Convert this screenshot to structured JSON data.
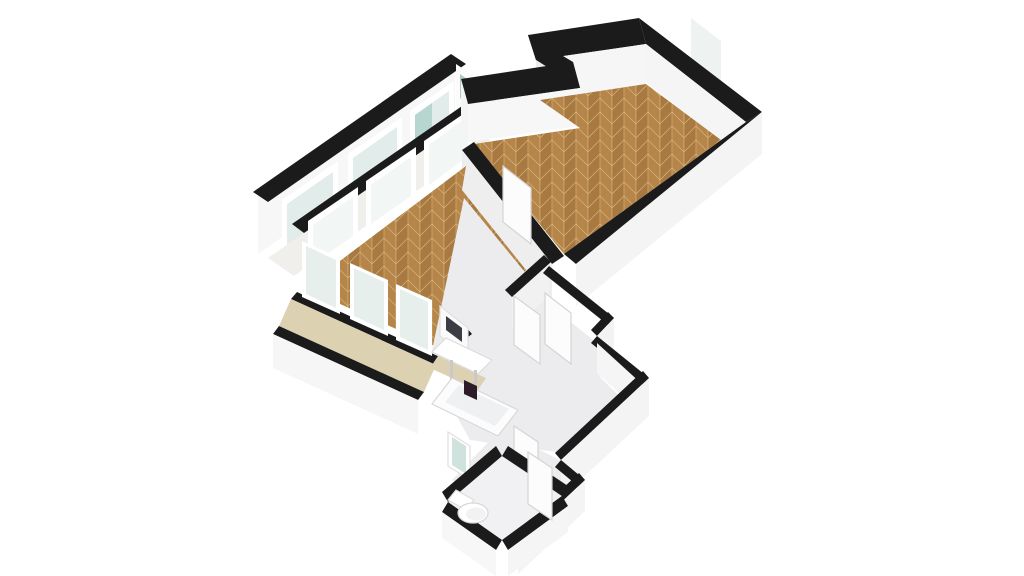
{
  "palette": {
    "background": "#ffffff",
    "wall_top": "#1b1b1b",
    "wall_face": "#f2f2f2",
    "parquet_a": "#b5854a",
    "parquet_b": "#a87a41",
    "parquet_line": "#d8b57c",
    "balcony_floor": "#f0efeb",
    "beige_floor": "#dcd2b2",
    "hall_floor": "#ececef",
    "glass": "#e2ecea",
    "glass_teal": "#aed0c9",
    "dark_accent": "#2e1b29"
  },
  "rooms": [
    {
      "name": "bedroom",
      "floor": "parquet-herringbone"
    },
    {
      "name": "living-room",
      "floor": "parquet-herringbone"
    },
    {
      "name": "balcony-north",
      "floor": "light"
    },
    {
      "name": "balcony-south",
      "floor": "beige"
    },
    {
      "name": "bathroom",
      "floor": "light-gray"
    },
    {
      "name": "hallway",
      "floor": "light-gray"
    },
    {
      "name": "wc",
      "floor": "light-gray"
    }
  ],
  "fixtures": [
    "toilet",
    "bathtub",
    "washbasin",
    "mirror-panel",
    "interior-doors",
    "windows",
    "glass-doors"
  ],
  "scene": {
    "shapes": [
      {
        "n": "balcony-outer-wall-face",
        "t": "p",
        "f": "#f7f7f7",
        "p": "258,196 455,58 455,116 258,254"
      },
      {
        "n": "balcony-outer-wall-top",
        "t": "p",
        "f": "#1b1b1b",
        "p": "253,192 451,54 466,64 268,202"
      },
      {
        "n": "balcony-window-1-frame",
        "t": "p",
        "f": "#ffffff",
        "p": "282,200 338,161 338,219 282,258"
      },
      {
        "n": "balcony-window-1-glass",
        "t": "p",
        "f": "#e2ecea",
        "p": "287,204 333,172 333,213 287,245"
      },
      {
        "n": "balcony-window-2-frame",
        "t": "p",
        "f": "#ffffff",
        "p": "348,154 402,117 402,175 348,212"
      },
      {
        "n": "balcony-window-2-glass",
        "t": "p",
        "f": "#e2ecea",
        "p": "353,158 397,127 397,169 353,200"
      },
      {
        "n": "balcony-window-3-frame",
        "t": "p",
        "f": "#ffffff",
        "p": "410,111 454,81 454,139 410,177"
      },
      {
        "n": "balcony-window-3-glass",
        "t": "p",
        "f": "#e2ecea",
        "p": "415,115 449,91 449,133 415,165"
      },
      {
        "n": "balcony-window-3-teal-pane",
        "t": "p",
        "f": "#b7d6cf",
        "p": "415,115 432,103 432,146 415,158"
      },
      {
        "n": "balcony-floor",
        "t": "p",
        "f": "#f0efeb",
        "p": "268,258 464,122 490,140 294,276"
      },
      {
        "n": "balcony-end-wall",
        "t": "p",
        "f": "#fbfbfb",
        "p": "456,64 480,80 480,132 456,116"
      },
      {
        "n": "balcony-end-glass",
        "t": "p",
        "f": "#a9cdc6",
        "p": "460,74 474,84 474,108 460,98"
      },
      {
        "n": "balcony-inner-wall-top",
        "t": "p",
        "f": "#1b1b1b",
        "p": "292,224 488,88 500,97 304,233"
      },
      {
        "n": "glass-door-1-frame",
        "t": "p",
        "f": "#ffffff",
        "p": "308,221 358,187 358,242 308,276"
      },
      {
        "n": "glass-door-1-glass",
        "t": "p",
        "f": "#eef3f1",
        "o": 0.75,
        "p": "313,225 353,197 353,236 313,264"
      },
      {
        "n": "glass-door-2-frame",
        "t": "p",
        "f": "#ffffff",
        "p": "366,181 416,147 416,202 366,236"
      },
      {
        "n": "glass-door-2-glass",
        "t": "p",
        "f": "#eef3f1",
        "o": 0.75,
        "p": "371,185 411,157 411,196 371,224"
      },
      {
        "n": "glass-door-3-frame",
        "t": "p",
        "f": "#ffffff",
        "p": "424,141 472,108 472,163 424,196"
      },
      {
        "n": "glass-door-3-glass",
        "t": "p",
        "f": "#eef3f1",
        "o": 0.75,
        "p": "429,145 467,117 467,157 429,185"
      },
      {
        "n": "bedroom-window-frame",
        "t": "p",
        "f": "#ffffff",
        "p": "686,12 726,43 726,97 686,66"
      },
      {
        "n": "bedroom-window-glass",
        "t": "p",
        "f": "#eef2f1",
        "p": "691,18 721,41 721,91 691,68"
      },
      {
        "n": "bedroom-window-sill",
        "t": "p",
        "f": "#f1f1f1",
        "p": "680,58 732,98 732,108 680,68"
      },
      {
        "n": "bedroom-ne-wall-top",
        "t": "p",
        "f": "#1b1b1b",
        "p": "639,18 762,112 746,122 646,44"
      },
      {
        "n": "bedroom-ne-wall-face",
        "t": "p",
        "f": "#f5f5f5",
        "p": "646,44 746,122 746,160 646,82"
      },
      {
        "n": "bedroom-facade-top",
        "t": "p",
        "f": "#1b1b1b",
        "p": "639,18 646,44 536,60 528,35"
      },
      {
        "n": "bedroom-facade-face",
        "t": "p",
        "f": "#f6f6f6",
        "p": "646,44 536,60 536,100 646,84"
      },
      {
        "n": "notch-step-top",
        "t": "p",
        "f": "#1b1b1b",
        "p": "528,35 536,60 580,88 573,62"
      },
      {
        "n": "notch-step-face",
        "t": "p",
        "f": "#ededed",
        "p": "536,60 580,88 580,126 536,98"
      },
      {
        "n": "notch-run-top",
        "t": "p",
        "f": "#1b1b1b",
        "p": "573,62 580,88 468,104 461,79"
      },
      {
        "n": "notch-run-face",
        "t": "p",
        "f": "#f7f7f7",
        "p": "580,88 468,104 468,142 580,126"
      },
      {
        "n": "bedroom-west-face",
        "t": "p",
        "f": "#f4f4f4",
        "p": "461,79 468,104 468,150 461,125"
      },
      {
        "n": "bedroom-floor",
        "t": "p",
        "f": "parquet",
        "p": "646,84 721,140 564,254 474,144 580,128 540,100"
      },
      {
        "n": "bedroom-se-wall-top",
        "t": "p",
        "f": "#1b1b1b",
        "p": "762,112 576,264 564,254 746,122"
      },
      {
        "n": "bedroom-se-outer-face",
        "t": "p",
        "f": "#f4f4f4",
        "p": "762,112 576,264 576,306 762,154"
      },
      {
        "n": "bedroom-spine-wall-top",
        "t": "p",
        "f": "#1b1b1b",
        "p": "474,142 564,256 552,264 462,150"
      },
      {
        "n": "bedroom-spine-wall-face",
        "t": "p",
        "f": "#eeeeee",
        "p": "462,150 552,264 552,306 462,192"
      },
      {
        "n": "bedroom-door-1",
        "t": "p",
        "f": "#fcfcfc",
        "s": "#d5d5d5",
        "p": "503,166 531,188 531,244 503,222"
      },
      {
        "n": "bedroom-door-2",
        "t": "p",
        "f": "#fcfcfc",
        "s": "#d5d5d5",
        "p": "500,253 528,274 528,328 500,307"
      },
      {
        "n": "living-room-floor",
        "t": "p",
        "f": "parquet",
        "p": "304,288 466,166 462,190 526,270 448,352"
      },
      {
        "n": "hall-floor-upper",
        "t": "p",
        "f": "#ececef",
        "p": "464,198 556,310 486,384 430,360"
      },
      {
        "n": "hall-floor-right",
        "t": "p",
        "f": "#ececef",
        "p": "556,310 618,360 600,377 618,395 556,452 470,440 442,390 486,350"
      },
      {
        "n": "hall-floor-lower",
        "t": "p",
        "f": "#ececef",
        "p": "500,430 580,470 520,530 452,480"
      },
      {
        "n": "living-se-wall-face",
        "t": "p",
        "f": "#f1f1f1",
        "p": "549,260 512,294 512,330 549,296"
      },
      {
        "n": "living-se-wall-top-1",
        "t": "p",
        "f": "#1b1b1b",
        "p": "551,262 512,297 505,290 544,255"
      },
      {
        "n": "living-se-wall-top-2",
        "t": "p",
        "f": "#1b1b1b",
        "p": "472,334 448,352 441,344 465,326"
      },
      {
        "n": "living-se-door",
        "t": "p",
        "f": "#fcfcfc",
        "s": "#d5d5d5",
        "p": "514,296 540,315 540,364 514,345"
      },
      {
        "n": "sill-wall-top",
        "t": "p",
        "f": "#1b1b1b",
        "p": "297,292 442,358 436,365 291,299"
      },
      {
        "n": "beige-balcony-floor",
        "t": "p",
        "f": "#dcd2b2",
        "p": "291,299 436,365 424,392 279,326"
      },
      {
        "n": "beige-window-1-frame",
        "t": "p",
        "f": "#ffffff",
        "p": "302,241 340,258 340,314 302,297"
      },
      {
        "n": "beige-window-1-glass",
        "t": "p",
        "f": "#e3ece9",
        "o": 0.85,
        "p": "306,246 336,260 336,308 306,294"
      },
      {
        "n": "beige-window-2-frame",
        "t": "p",
        "f": "#ffffff",
        "p": "350,263 388,280 388,336 350,319"
      },
      {
        "n": "beige-window-2-glass",
        "t": "p",
        "f": "#e3ece9",
        "o": 0.85,
        "p": "354,268 384,282 384,330 354,316"
      },
      {
        "n": "beige-window-3-frame",
        "t": "p",
        "f": "#ffffff",
        "p": "396,284 432,300 432,356 396,340"
      },
      {
        "n": "beige-window-3-glass",
        "t": "p",
        "f": "#e3ece9",
        "o": 0.85,
        "p": "400,289 428,302 428,350 400,337"
      },
      {
        "n": "beige-outer-wall-top",
        "t": "p",
        "f": "#1b1b1b",
        "p": "279,326 424,392 418,400 273,334"
      },
      {
        "n": "beige-outer-wall-face",
        "t": "p",
        "f": "#f6f6f6",
        "p": "273,334 418,400 418,434 273,368"
      },
      {
        "n": "beige-ledge",
        "t": "p",
        "f": "#dcd2b2",
        "p": "438,356 486,378 478,390 430,368"
      },
      {
        "n": "bath-mirror-panel",
        "t": "p",
        "f": "#fafafa",
        "s": "#e0e0e0",
        "p": "440,306 468,328 468,358 440,336"
      },
      {
        "n": "bath-mirror-glass",
        "t": "p",
        "f": "#3c3c44",
        "p": "446,316 462,328 462,342 446,330"
      },
      {
        "n": "bath-sink-table",
        "t": "p",
        "f": "#ffffff",
        "s": "#dcdcdc",
        "p": "446,338 492,360 478,374 432,352"
      },
      {
        "n": "bath-sink-leg-1",
        "t": "p",
        "f": "#c9c9c9",
        "p": "450,360 453,360 453,380 450,380"
      },
      {
        "n": "bath-sink-leg-2",
        "t": "p",
        "f": "#c9c9c9",
        "p": "474,370 477,370 477,390 474,390"
      },
      {
        "n": "bathtub-outer",
        "t": "p",
        "f": "#fcfcfc",
        "s": "#d8d8d8",
        "p": "452,378 518,410 498,436 432,404"
      },
      {
        "n": "bathtub-inner",
        "t": "p",
        "f": "#eef0f2",
        "p": "459,385 509,409 495,426 445,402"
      },
      {
        "n": "bath-dark-object",
        "t": "p",
        "f": "#2e1b29",
        "p": "464,380 477,386 477,400 464,394"
      },
      {
        "n": "hall-ne-wall-top-1",
        "t": "p",
        "f": "#1b1b1b",
        "p": "549,266 614,318 608,325 543,273"
      },
      {
        "n": "hall-jog-top",
        "t": "p",
        "f": "#1b1b1b",
        "p": "614,318 597,336 591,330 608,312"
      },
      {
        "n": "hall-jog-face",
        "t": "p",
        "f": "#f3f3f3",
        "p": "614,318 597,336 597,370 614,352"
      },
      {
        "n": "hall-ne-wall-top-2",
        "t": "p",
        "f": "#1b1b1b",
        "p": "597,336 649,378 643,385 591,343"
      },
      {
        "n": "hall-ne-wall-face-2",
        "t": "p",
        "f": "#f5f5f5",
        "p": "597,343 643,385 643,415 597,373"
      },
      {
        "n": "hall-se-wall-top",
        "t": "p",
        "f": "#1b1b1b",
        "p": "649,378 561,460 555,453 643,371"
      },
      {
        "n": "hall-se-wall-face",
        "t": "p",
        "f": "#f4f4f4",
        "p": "649,378 561,460 561,498 649,416"
      },
      {
        "n": "hall-jog2-top",
        "t": "p",
        "f": "#1b1b1b",
        "p": "561,460 585,480 579,487 555,467"
      },
      {
        "n": "hall-se-wall-top-3",
        "t": "p",
        "f": "#1b1b1b",
        "p": "585,480 518,543 512,536 579,473"
      },
      {
        "n": "hall-se-wall-face-3",
        "t": "p",
        "f": "#f4f4f4",
        "p": "585,480 518,543 518,574 585,511"
      },
      {
        "n": "alcove-door",
        "t": "p",
        "f": "#fcfcfc",
        "s": "#d5d5d5",
        "p": "545,293 571,313 571,364 545,344"
      },
      {
        "n": "hall-door",
        "t": "p",
        "f": "#fcfcfc",
        "s": "#d5d5d5",
        "p": "514,426 538,442 538,491 514,475"
      },
      {
        "n": "hall-window-frame",
        "t": "p",
        "f": "#ffffff",
        "s": "#e0e0e0",
        "p": "448,432 470,446 470,480 448,466"
      },
      {
        "n": "hall-window-glass",
        "t": "p",
        "f": "#cfe2dd",
        "p": "452,437 466,446 466,474 452,465"
      },
      {
        "n": "wc-floor",
        "t": "p",
        "f": "#f1f1f3",
        "p": "502,456 562,496 502,540 448,502"
      },
      {
        "n": "wc-wall-top-nw",
        "t": "p",
        "f": "#1b1b1b",
        "p": "502,456 448,502 442,492 496,446"
      },
      {
        "n": "wc-wall-top-ne",
        "t": "p",
        "f": "#1b1b1b",
        "p": "508,446 568,486 562,496 502,456"
      },
      {
        "n": "wc-wall-top-se",
        "t": "p",
        "f": "#1b1b1b",
        "p": "562,496 502,540 508,550 568,506"
      },
      {
        "n": "wc-wall-top-sw",
        "t": "p",
        "f": "#1b1b1b",
        "p": "502,540 448,502 442,512 496,550"
      },
      {
        "n": "wc-outer-face-se",
        "t": "p",
        "f": "#f5f5f5",
        "p": "568,506 508,550 508,576 568,532"
      },
      {
        "n": "wc-outer-face-sw",
        "t": "p",
        "f": "#f7f7f7",
        "p": "496,550 442,512 442,538 496,576"
      },
      {
        "n": "toilet-tank",
        "t": "p",
        "f": "#ffffff",
        "s": "#dddddd",
        "p": "456,490 474,500 466,510 448,500"
      },
      {
        "n": "toilet-bowl",
        "t": "e",
        "cx": 473,
        "cy": 513,
        "rx": 15,
        "ry": 10,
        "f": "#ffffff",
        "s": "#d8d8d8"
      },
      {
        "n": "toilet-seat",
        "t": "e",
        "cx": 476,
        "cy": 514,
        "rx": 10,
        "ry": 6.5,
        "f": "#f2f2f2"
      },
      {
        "n": "wc-door",
        "t": "p",
        "f": "#fcfcfc",
        "s": "#d5d5d5",
        "p": "528,452 552,468 552,520 528,504"
      }
    ]
  }
}
